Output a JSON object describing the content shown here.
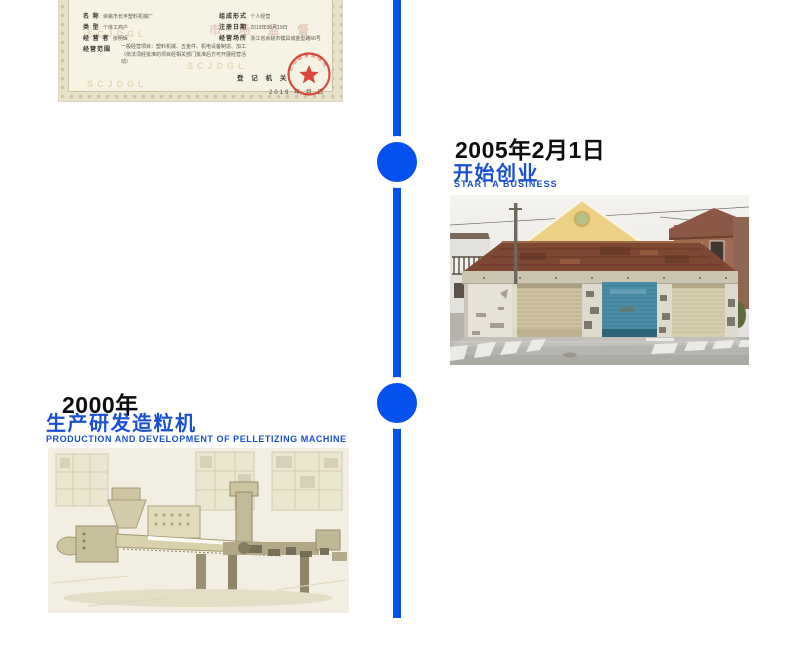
{
  "page": {
    "background_color": "#ffffff",
    "timeline_color": "#0451ef",
    "accent_blue": "#1b50d1",
    "date_text_color": "#0d0d0d"
  },
  "events": [
    {
      "date": "2005年2月1日",
      "title_cn": "开始创业",
      "title_en": "START A BUSINESS",
      "photo": "old-garage-building-photo",
      "photo_colors": {
        "roof": "#7c4733",
        "middle_door": "#4b8da4",
        "side_doors": "#cdc2a2",
        "gable_house": "#ecd084"
      }
    },
    {
      "date": "2000年",
      "title_cn": "生产研发造粒机",
      "title_en": "PRODUCTION AND DEVELOPMENT OF PELLETIZING MACHINE",
      "photo": "pelletizing-machine-photo",
      "photo_colors": {
        "paper": "#f2efe2",
        "machine": "#c8bf9c"
      }
    }
  ],
  "certificate": {
    "paper_color": "#f7f3e4",
    "border_color": "#cdc5a3",
    "seal_color": "#d5382b",
    "watermark": "SCJDGL",
    "watermark2": "市 场 监 督",
    "fields_left": [
      {
        "label": "名    称",
        "value": "余姚市长丰塑料机械厂"
      },
      {
        "label": "类    型",
        "value": "个体工商户"
      },
      {
        "label": "经 营 者",
        "value": "张明辉"
      },
      {
        "label": "经营范围",
        "value": "一般经营项目：塑料机械、五金件、机电设备制造、加工（依法须经批准的项目经相关部门批准后方可开展经营活动）"
      }
    ],
    "fields_right": [
      {
        "label": "组成形式",
        "value": "个人经营"
      },
      {
        "label": "注册日期",
        "value": "2019年06月19日"
      },
      {
        "label": "经营场所",
        "value": "浙江省余姚市模具城金型路66号"
      }
    ],
    "registry_label": "登 记 机 关",
    "date_line": "2019  年    月    日",
    "seal_text": "市场监督管理局"
  }
}
